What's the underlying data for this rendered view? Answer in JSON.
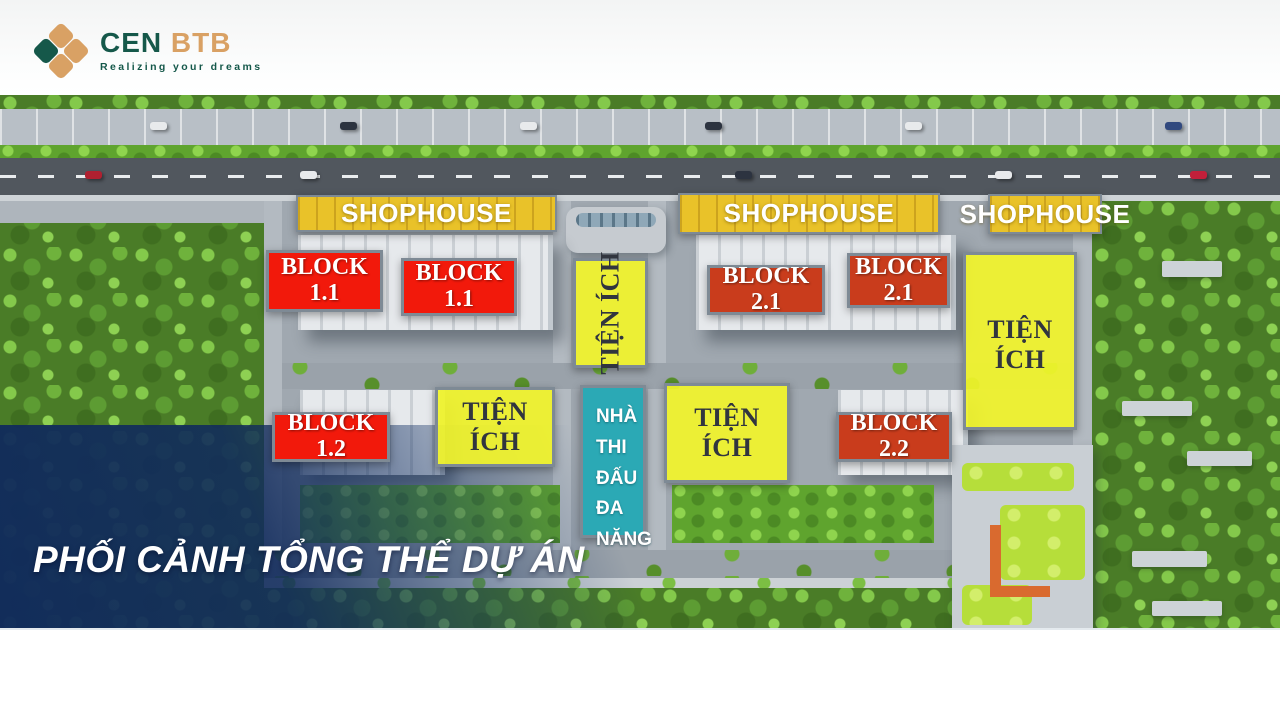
{
  "logo": {
    "brand_primary": "CEN",
    "brand_secondary": "BTB",
    "tagline": "Realizing your dreams"
  },
  "banner_title": "PHỐI CẢNH TỔNG THỂ DỰ ÁN",
  "site_plan": {
    "shophouses": [
      {
        "label": "SHOPHOUSE"
      },
      {
        "label": "SHOPHOUSE"
      },
      {
        "label": "SHOPHOUSE"
      }
    ],
    "blocks": [
      {
        "name": "BLOCK",
        "number": "1.1",
        "variant": "bright"
      },
      {
        "name": "BLOCK",
        "number": "1.1",
        "variant": "bright"
      },
      {
        "name": "BLOCK",
        "number": "2.1",
        "variant": "dark"
      },
      {
        "name": "BLOCK",
        "number": "2.1",
        "variant": "dark"
      },
      {
        "name": "BLOCK",
        "number": "1.2",
        "variant": "bright"
      },
      {
        "name": "BLOCK",
        "number": "2.2",
        "variant": "dark"
      }
    ],
    "amenities": [
      {
        "label": "TIỆN ÍCH",
        "orientation": "vertical"
      },
      {
        "label": "TIỆN ÍCH",
        "orientation": "horizontal"
      },
      {
        "label": "TIỆN ÍCH",
        "orientation": "horizontal"
      },
      {
        "label": "TIỆN ÍCH",
        "orientation": "horizontal"
      }
    ],
    "sports_hall": {
      "lines": [
        "NHÀ",
        "THI",
        "ĐẤU",
        "ĐA",
        "NĂNG"
      ]
    }
  },
  "colors": {
    "block_red_bright": "#f2190b",
    "block_red_dark": "#c93c1c",
    "shophouse_gold": "#e9c229",
    "amenity_yellow": "#f2f52a",
    "sports_teal": "#2ba9b5",
    "overlay_navy": "#102a5c",
    "label_border_gray": "#7e8a95",
    "logo_green": "#15584a",
    "logo_tan": "#d9a164"
  }
}
